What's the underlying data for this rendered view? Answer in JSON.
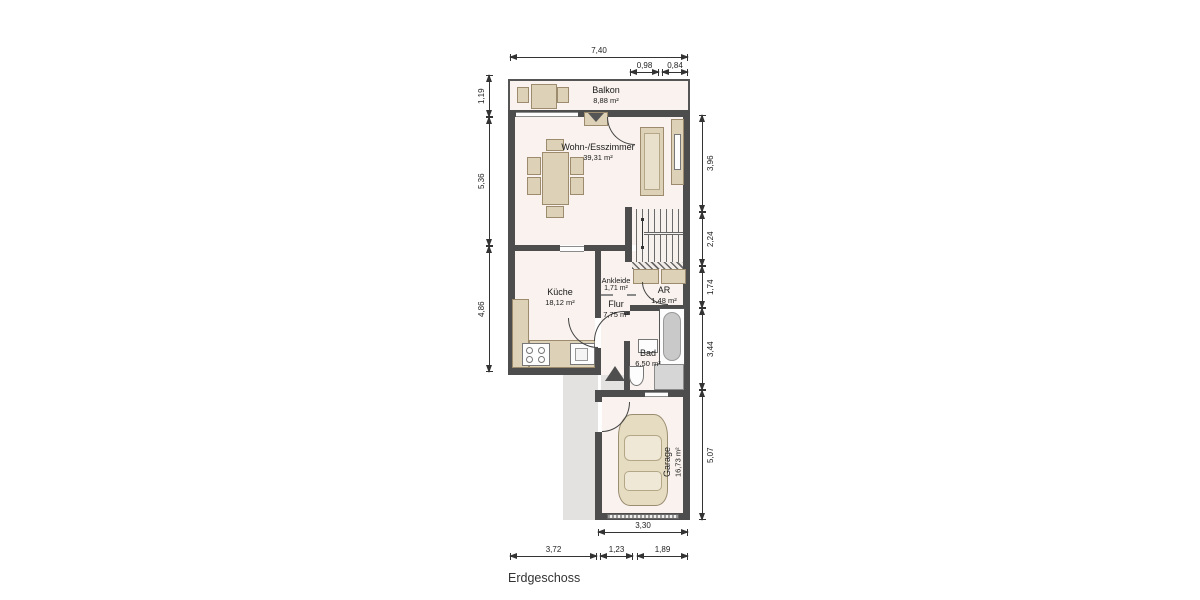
{
  "title": "Erdgeschoss",
  "rooms": {
    "balkon": {
      "name": "Balkon",
      "area": "8,88 m²"
    },
    "wohn": {
      "name": "Wohn-/Esszimmer",
      "area": "39,31 m²"
    },
    "kueche": {
      "name": "Küche",
      "area": "18,12 m²"
    },
    "ankleide": {
      "name": "Ankleide",
      "area": "1,71 m²"
    },
    "flur": {
      "name": "Flur",
      "area": "7,75 m²"
    },
    "ar": {
      "name": "AR",
      "area": "1,48 m²"
    },
    "bad": {
      "name": "Bad",
      "area": "6,50 m²"
    },
    "garage": {
      "name": "Garage",
      "area": "16,73 m²"
    }
  },
  "dims": {
    "d740": "7,40",
    "d098": "0,98",
    "d084": "0,84",
    "d119": "1,19",
    "d536": "5,36",
    "d486": "4,86",
    "d396": "3,96",
    "d224": "2,24",
    "d174": "1,74",
    "d344": "3,44",
    "d507": "5,07",
    "d330": "3,30",
    "d372": "3,72",
    "d123": "1,23",
    "d189": "1,89"
  },
  "colors": {
    "wall": "#4d4d4d",
    "floor": "#f9f2ee",
    "furniture": "#ddd2b8",
    "outdoor": "#e3e2e0",
    "dimension": "#333333"
  }
}
